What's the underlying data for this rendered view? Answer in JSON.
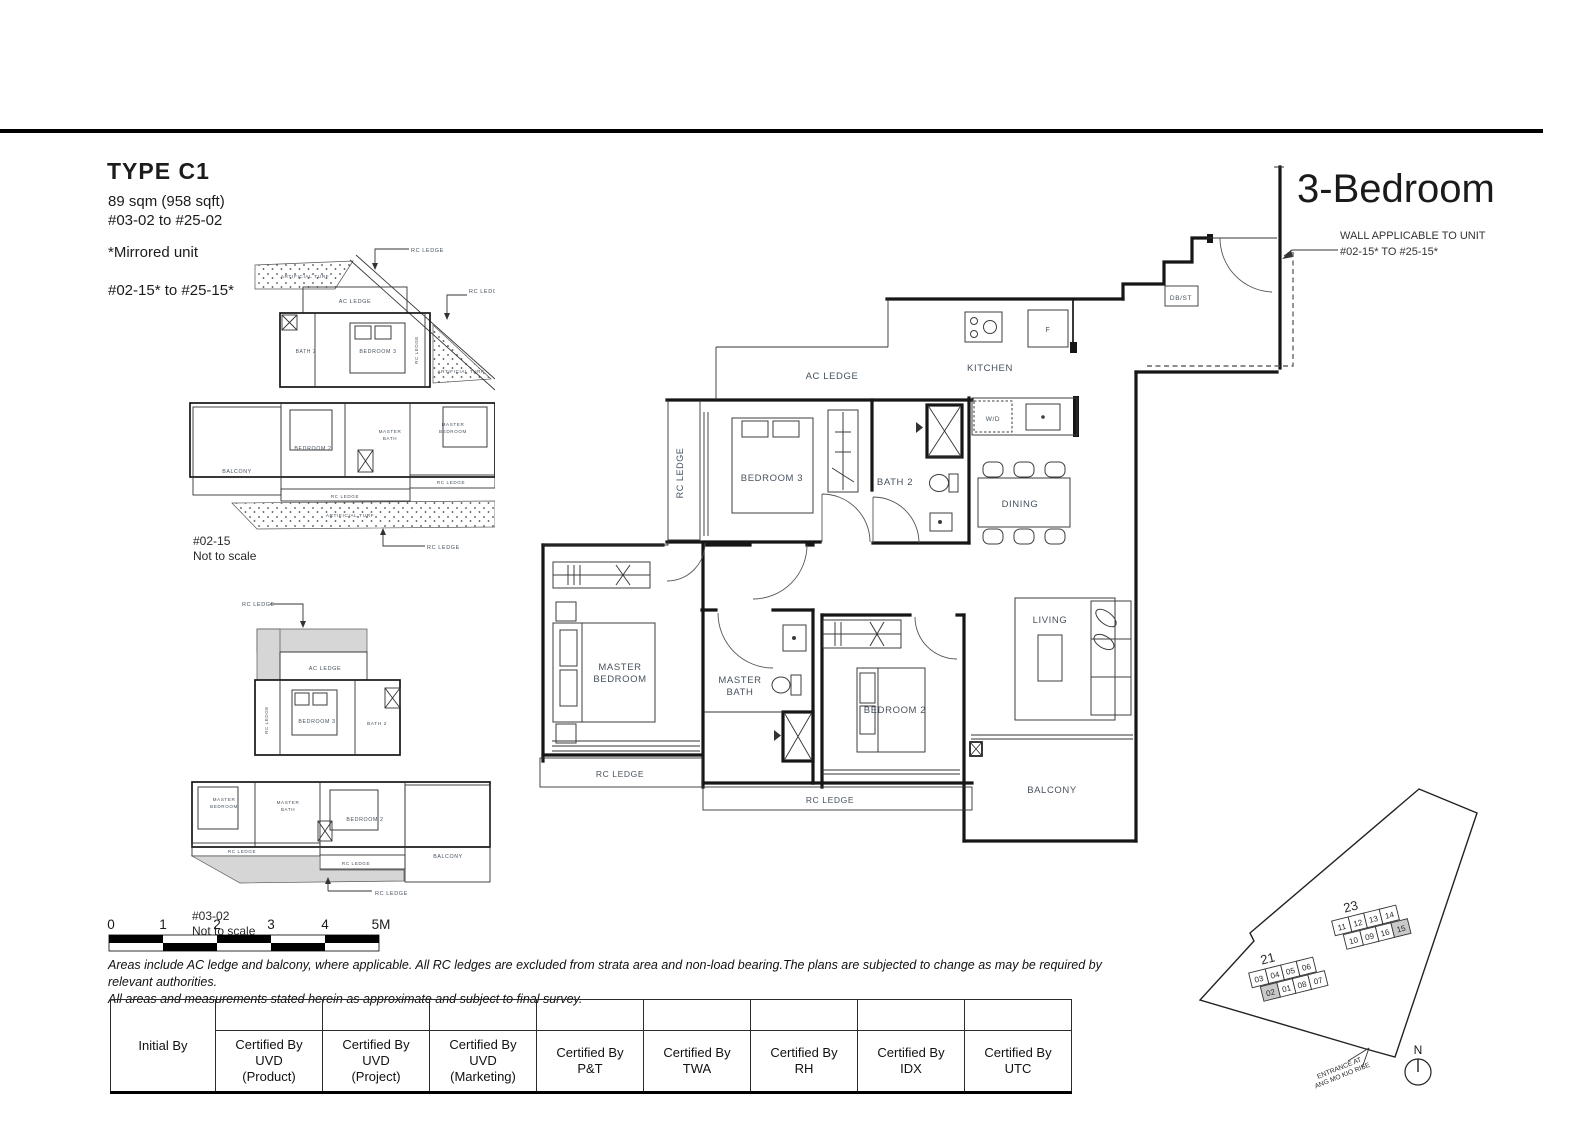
{
  "page": {
    "header": {
      "type_title": "TYPE C1",
      "area": "89 sqm (958 sqft)",
      "unit_range": "#03-02 to #25-02",
      "mirrored_note": "*Mirrored unit",
      "mirrored_range": "#02-15* to #25-15*"
    },
    "plan_title": "3-Bedroom",
    "wall_note": {
      "line1": "WALL APPLICABLE TO UNIT",
      "line2": "#02-15* TO #25-15*"
    }
  },
  "main_plan": {
    "labels": {
      "ac_ledge": "AC LEDGE",
      "kitchen": "KITCHEN",
      "rc_ledge_v": "RC LEDGE",
      "bedroom3": "BEDROOM 3",
      "bath2": "BATH 2",
      "dining": "DINING",
      "wd": "W/D",
      "fridge": "F",
      "db_st": "DB/ST",
      "master1": "MASTER",
      "master2": "BEDROOM",
      "mbath1": "MASTER",
      "mbath2": "BATH",
      "bedroom2": "BEDROOM 2",
      "living": "LIVING",
      "balcony": "BALCONY",
      "rc_ledge_bl": "RC LEDGE",
      "rc_ledge_b": "RC LEDGE"
    }
  },
  "plan_a": {
    "caption": "#02-15",
    "scale_note": "Not to scale",
    "labels": {
      "rc_ledge_top": "RC LEDGE",
      "rc_ledge_right": "RC LEDGE",
      "turf_top": "ARTIFICIAL TURF",
      "ac_ledge": "AC LEDGE",
      "bath2": "BATH 2",
      "bedroom3": "BEDROOM 3",
      "rc_ledge_v": "RC LEDGE",
      "turf_right": "ARTIFICIAL TURF",
      "balcony": "BALCONY",
      "bedroom2": "BEDROOM 2",
      "mbath1": "MASTER",
      "mbath2": "BATH",
      "mbed1": "MASTER",
      "mbed2": "BEDROOM",
      "rc_ledge_mid": "RC LEDGE",
      "rc_ledge_low": "RC LEDGE",
      "turf_bottom": "ARTIFICIAL TURF",
      "rc_ledge_bottom": "RC LEDGE"
    }
  },
  "plan_b": {
    "caption": "#03-02",
    "scale_note": "Not to scale",
    "labels": {
      "rc_ledge_top": "RC LEDGE",
      "ac_ledge": "AC LEDGE",
      "rc_ledge_v": "RC LEDGE",
      "bedroom3": "BEDROOM 3",
      "bath2": "BATH 2",
      "mbed1": "MASTER",
      "mbed2": "BEDROOM",
      "mbath1": "MASTER",
      "mbath2": "BATH",
      "bedroom2": "BEDROOM 2",
      "balcony": "BALCONY",
      "rc_ledge_mid": "RC LEDGE",
      "rc_ledge_low": "RC LEDGE",
      "rc_ledge_bottom": "RC LEDGE"
    }
  },
  "scale_bar": {
    "ticks": [
      "0",
      "1",
      "2",
      "3",
      "4",
      "5M"
    ]
  },
  "notes": {
    "line1": "Areas include AC ledge and balcony, where applicable. All RC ledges are excluded from strata area and non-load bearing.The plans are subjected to change as may be required by relevant authorities.",
    "line2": "All areas and measurements stated herein as approximate and subject to final survey."
  },
  "approval_table": {
    "initial": "Initial By",
    "certifiers": [
      [
        "Certified By",
        "UVD",
        "(Product)"
      ],
      [
        "Certified By",
        "UVD",
        "(Project)"
      ],
      [
        "Certified By",
        "UVD",
        "(Marketing)"
      ],
      [
        "Certified By",
        "P&T"
      ],
      [
        "Certified By",
        "TWA"
      ],
      [
        "Certified By",
        "RH"
      ],
      [
        "Certified By",
        "IDX"
      ],
      [
        "Certified By",
        "UTC"
      ]
    ]
  },
  "site_plan": {
    "north": "N",
    "entrance1": "ENTRANCE AT",
    "entrance2": "ANG MO KIO RISE",
    "block21": "21",
    "block23": "23",
    "units21_top": [
      "03",
      "04",
      "05",
      "06"
    ],
    "units21_bottom": [
      "02",
      "01",
      "08",
      "07"
    ],
    "units23_top": [
      "11",
      "12",
      "13",
      "14"
    ],
    "units23_bottom": [
      "10",
      "09",
      "16",
      "15"
    ]
  }
}
